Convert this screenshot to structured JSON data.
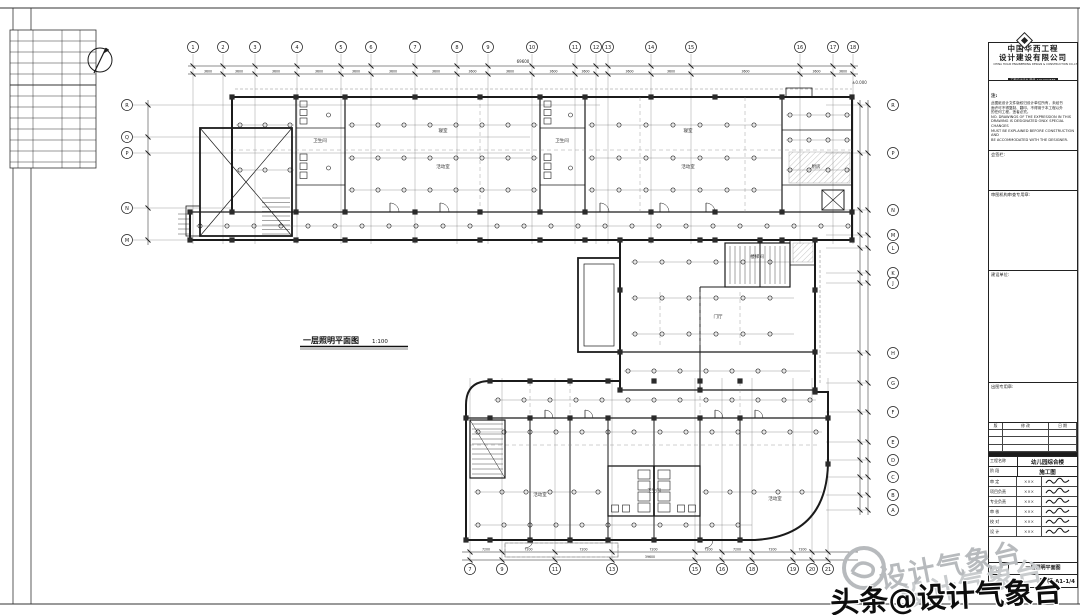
{
  "page": {
    "bg": "#ffffff",
    "ink": "#1b1b1b",
    "gray": "#8a8a8a",
    "hatch": "#9a9a9a",
    "column": "#2a2a2a",
    "watermark_gray": "#b7babd"
  },
  "plan": {
    "title": "一层照明平面图",
    "scale": "1:100",
    "level_note": "±0.000",
    "room_labels": [
      {
        "t": "活动室",
        "x": 443,
        "y": 168
      },
      {
        "t": "寝室",
        "x": 443,
        "y": 132
      },
      {
        "t": "卫生间",
        "x": 320,
        "y": 142
      },
      {
        "t": "卫生间",
        "x": 562,
        "y": 142
      },
      {
        "t": "活动室",
        "x": 688,
        "y": 168
      },
      {
        "t": "寝室",
        "x": 688,
        "y": 132
      },
      {
        "t": "厨房",
        "x": 816,
        "y": 168
      },
      {
        "t": "门厅",
        "x": 718,
        "y": 318
      },
      {
        "t": "楼梯间",
        "x": 757,
        "y": 258
      },
      {
        "t": "活动室",
        "x": 540,
        "y": 496
      },
      {
        "t": "卫生间",
        "x": 654,
        "y": 492
      },
      {
        "t": "活动室",
        "x": 775,
        "y": 500
      }
    ]
  },
  "axes": {
    "top": {
      "labels": [
        "1",
        "2",
        "3",
        "4",
        "5",
        "6",
        "7",
        "8",
        "9",
        "10",
        "11",
        "12",
        "13",
        "14",
        "15",
        "16",
        "17",
        "18"
      ],
      "xs": [
        193,
        223,
        255,
        297,
        341,
        371,
        415,
        457,
        488,
        532,
        575,
        596,
        608,
        651,
        691,
        800,
        833,
        853
      ]
    },
    "bottom": {
      "labels": [
        "7",
        "9",
        "11",
        "13",
        "15",
        "16",
        "18",
        "19",
        "20",
        "21"
      ],
      "xs": [
        470,
        502,
        555,
        612,
        695,
        722,
        752,
        793,
        812,
        828
      ]
    },
    "left": {
      "labels": [
        "R",
        "Q",
        "P",
        "N",
        "M"
      ],
      "ys": [
        105,
        137,
        153,
        208,
        240
      ]
    },
    "right": {
      "labels": [
        "R",
        "P",
        "N",
        "M",
        "L",
        "K",
        "J",
        "H",
        "G",
        "F",
        "E",
        "D",
        "C",
        "B",
        "A"
      ],
      "ys": [
        105,
        153,
        210,
        235,
        248,
        273,
        283,
        353,
        383,
        412,
        442,
        460,
        477,
        495,
        510
      ]
    }
  },
  "dims": {
    "typical": "3600",
    "typical2": "7200",
    "total_top": "69600",
    "total_bottom": "39600"
  },
  "title_block": {
    "logo": {
      "name_cn_1": "中国华西工程",
      "name_cn_2": "设计建设有限公司",
      "name_en": "CHINA HUAXI ENGINEERING DESIGN & CONSTRUCTION CO.,LTD.",
      "cert": "工程设计证书 甲级 A151004586"
    },
    "notice_title": "注:",
    "notice_lines": [
      "此图纸设计文件版权归设计单位所有，未经书",
      "面许可不得复制、翻印，不得用于本工程以外",
      "的任何工程，违者必究。",
      "NO. DRAWINGS OF THE EXPRESSION IN THIS",
      "DRAWING IS DESIGNATED ONLY. SPECIAL CHANGES",
      "MUST BE EXPLAINED BEFORE CONSTRUCTION AND",
      "BE ACCOMMODATED WITH THE DESIGNER."
    ],
    "sections": [
      {
        "label": "会签栏:"
      },
      {
        "label": "审图机构审查专用章:"
      },
      {
        "label": "建设单位:"
      },
      {
        "label": "出图专用章:"
      }
    ],
    "rev_headers": [
      "版",
      "修 改",
      "日 期"
    ],
    "project_label": "工程名称",
    "project_value": "幼儿园综合楼",
    "stage_label": "阶 段",
    "stage_value": "施工图",
    "sign_roles": [
      "审 定",
      "项目负责",
      "专业负责",
      "审 核",
      "校 对",
      "设 计"
    ],
    "sign_names": [
      "×××",
      "×××",
      "×××",
      "×××",
      "×××",
      "×××"
    ],
    "footer": {
      "name_label": "图 名",
      "sheet_text": "图 幅:A1-1/4"
    }
  },
  "watermark": {
    "diagonal_text": "设计气象台",
    "byline": "头条@设计气象台"
  }
}
